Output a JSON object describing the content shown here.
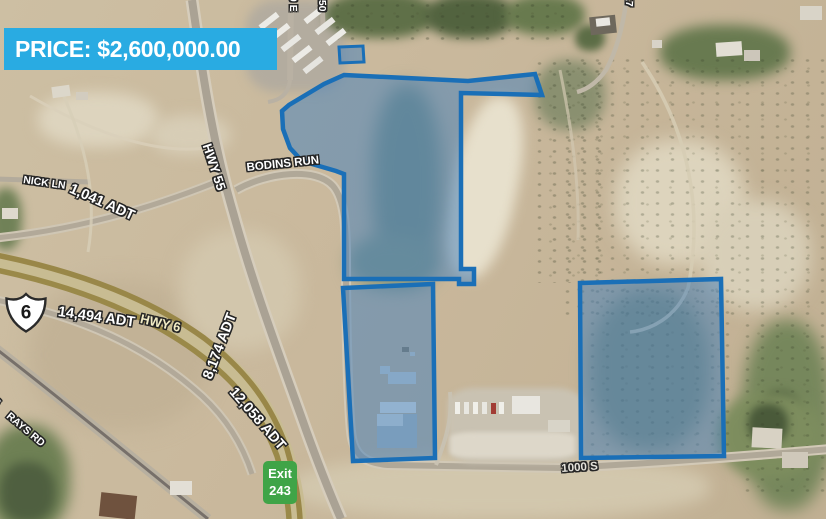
{
  "price_banner": {
    "text": "PRICE: $2,600,000.00",
    "bg": "#29abe2"
  },
  "route_shield": {
    "route": "6"
  },
  "exit_sign": {
    "line1": "Exit",
    "line2": "243",
    "bg": "#3fa447"
  },
  "road_labels": {
    "nick_ln": "NICK LN",
    "hwy_55": "HWY 55",
    "bodins_run": "BODINS RUN",
    "hwy_6": "HWY 6",
    "rays_rd": "RAYS RD",
    "rays_rd_partial": "S",
    "street_1000_s": "1000 S",
    "street_50_e": "50 E",
    "street_150": "150",
    "street_17": "17"
  },
  "traffic_counts": {
    "nick_ln": "1,041 ADT",
    "hwy_6": "14,494 ADT",
    "hwy_55_south": "8,174 ADT",
    "us6_south": "12,058 ADT"
  },
  "colors": {
    "banner_bg": "#29abe2",
    "exit_sign_bg": "#3fa447",
    "parcel_stroke": "#1a6fb7",
    "parcel_fill": "rgba(64,126,188,0.5)",
    "hwy6_label": "#f2ecc6"
  }
}
